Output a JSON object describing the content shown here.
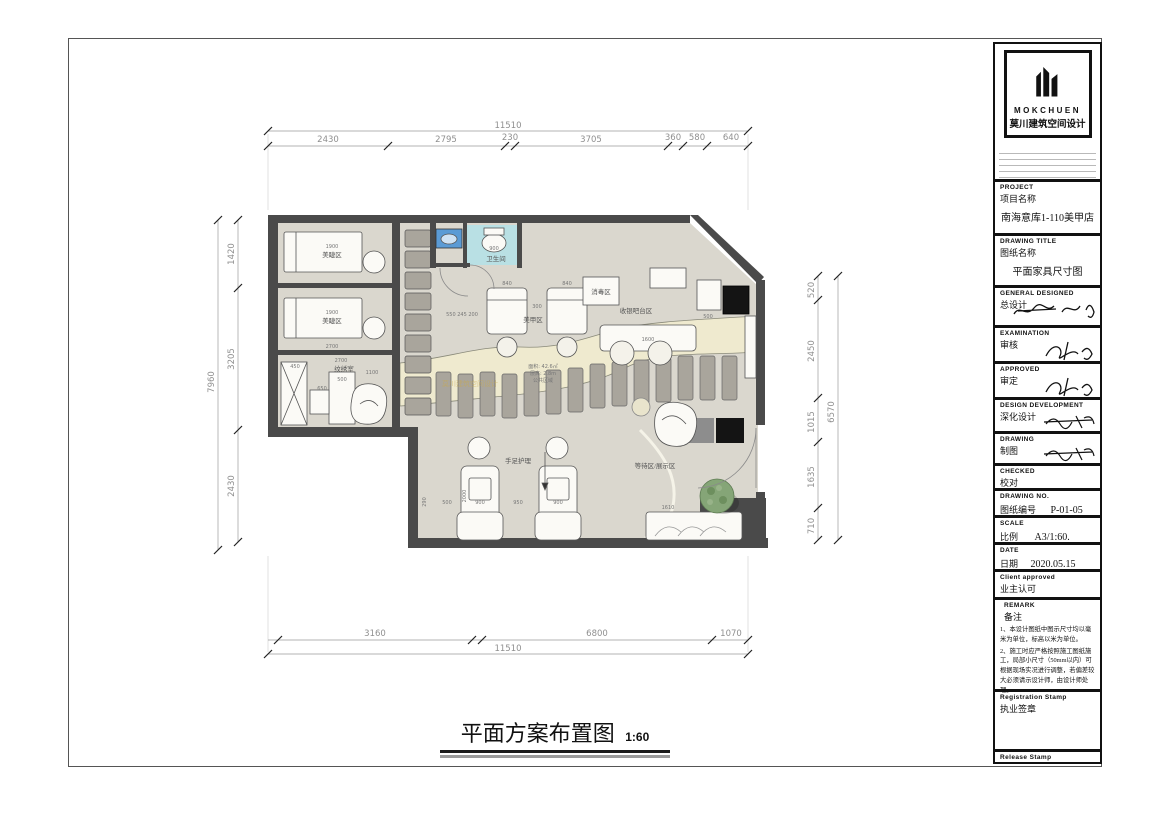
{
  "titleblock": {
    "logo": {
      "brand": "MOKCHUEN",
      "brand_cn": "莫川建筑空间设计",
      "icon": "buildings-icon"
    },
    "sections": {
      "project": {
        "en": "PROJECT",
        "cn": "项目名称",
        "value": "南海意库1-110美甲店"
      },
      "drawing_title": {
        "en": "DRAWING TITLE",
        "cn": "图纸名称",
        "value": "平面家具尺寸图"
      },
      "general_designed": {
        "en": "GENERAL  DESIGNED",
        "cn": "总设计"
      },
      "examination": {
        "en": "EXAMINATION",
        "cn": "审核"
      },
      "approved": {
        "en": "APPROVED",
        "cn": "审定"
      },
      "design_development": {
        "en": "DESIGN DEVELOPMENT",
        "cn": "深化设计"
      },
      "drawing": {
        "en": "DRAWING",
        "cn": "制图"
      },
      "checked": {
        "en": "CHECKED",
        "cn": "校对"
      },
      "drawing_no": {
        "en": "DRAWING NO.",
        "cn": "图纸编号",
        "value": "P-01-05"
      },
      "scale": {
        "en": "SCALE",
        "cn": "比例",
        "value": "A3/1:60."
      },
      "date": {
        "en": "DATE",
        "cn": "日期",
        "value": "2020.05.15"
      },
      "client_approved": {
        "en": "Client approved",
        "cn": "业主认可"
      },
      "remark": {
        "en": "REMARK",
        "cn": "备注",
        "notes": [
          "1、本设计图纸中图示尺寸均以毫米为单位，标高以米为单位。",
          "2、施工时应严格按照施工图纸施工，局部小尺寸（50mm以内）可根据现场实况进行调整，若偏差较大必须请示设计师，由设计师处理。"
        ]
      },
      "registration_stamp": {
        "en": "Registration Stamp",
        "cn": "执业签章"
      },
      "release_stamp": {
        "en": "Release Stamp",
        "cn": "出图签章"
      }
    }
  },
  "plan_title": {
    "text": "平面方案布置图",
    "scale": "1:60"
  },
  "dims": {
    "top": {
      "total": "11510",
      "segments": [
        "2430",
        "2795",
        "230",
        "3705",
        "360",
        "580",
        "640"
      ]
    },
    "bottom": {
      "total": "11510",
      "segments": [
        "3160",
        "6800",
        "1070"
      ]
    },
    "left": {
      "total": "7960",
      "segments": [
        "1420",
        "3205",
        "2430"
      ]
    },
    "right": {
      "total": "6570",
      "segments": [
        "520",
        "2450",
        "1015",
        "1635",
        "710"
      ]
    }
  },
  "labels": {
    "lash1": "美睫区",
    "lash1_dim": "1900",
    "lash2": "美睫区",
    "lash2_dim": "1900",
    "lash2_w": "2700",
    "tattoo": "纹绣室",
    "tattoo_w": "2700",
    "tattoo_d1": "450",
    "tattoo_d2": "650",
    "tattoo_d3": "500",
    "tattoo_d4": "1100",
    "bath": "卫生间",
    "bath_dim": "900",
    "nail": "美甲区",
    "nail_d1": "840",
    "nail_d2": "840",
    "nail_gap": "300",
    "sterilize": "消毒区",
    "cashier": "收银吧台区",
    "cashier_dim": "1600",
    "cashier_d2": "500",
    "pedicure": "手足护理",
    "ped_d1": "900",
    "ped_d2": "900",
    "ped_d3": "950",
    "ped_d4": "2000",
    "ped_d5": "290",
    "ped_d6": "500",
    "waiting": "等待区/展示区",
    "common_area": "面积: 42.6㎡",
    "common_height": "层高: 2.8m",
    "common": "公共区域",
    "bench_dim": "1610",
    "shelf_dims": "550 245 200",
    "watermark": "莫川建筑空间设计"
  },
  "colors": {
    "wall": "#4a4a4a",
    "floor": "#dad7ce",
    "bathroom_floor": "#b9e0e4",
    "path_band": "#efeacf",
    "furniture_gray": "#a9a59c",
    "tree_green": "#85a577",
    "sink_blue": "#5b9bd5",
    "dim_text": "#8f8f8f",
    "watermark_gold": "#c9a84c"
  }
}
